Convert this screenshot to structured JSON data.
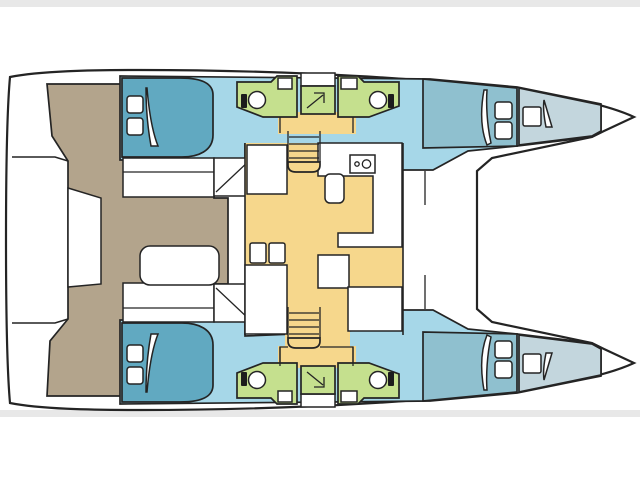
{
  "page": {
    "background": "#ffffff",
    "frame_color": "#e8e8e8"
  },
  "plan": {
    "vessel_type": "catamaran",
    "view": "top-down interior deck plan",
    "bow_direction": "right",
    "cabin_count": 4,
    "bathroom_count": 4,
    "staircase_count": 2,
    "companionway_arrow_count": 2
  },
  "colors": {
    "outline": "#242424",
    "deck": "#ffffff",
    "cabin_floor": "#a6d7e8",
    "bed": "#61a9c1",
    "forward_cabin": "#8fc0cf",
    "bow_locker": "#c3d6dd",
    "bathroom": "#c5e08e",
    "salon": "#f6d78c",
    "cockpit": "#b3a48c",
    "fixture_white": "#ffffff"
  },
  "rooms": {
    "port_aft_cabin": "double cabin aft (port)",
    "port_bathroom_aft": "bathroom (port aft)",
    "port_bathroom_fwd": "bathroom (port fwd)",
    "port_fwd_cabin": "double cabin fwd (port)",
    "port_bow_locker": "bow storage (port)",
    "stbd_aft_cabin": "double cabin aft (starboard)",
    "stbd_bathroom_aft": "bathroom (starboard aft)",
    "stbd_bathroom_fwd": "bathroom (starboard fwd)",
    "stbd_fwd_cabin": "double cabin fwd (starboard)",
    "stbd_bow_locker": "bow storage (starboard)",
    "salon": "salon / dinette",
    "galley": "galley",
    "cockpit": "aft cockpit",
    "swim_platform": "stern platforms",
    "trampoline": "foredeck / trampoline"
  },
  "fixtures": {
    "beds": "double berths with pillows",
    "toilets": "marine toilets",
    "sinks": "wash basins",
    "stove": "two-burner stove",
    "galley_sink": "galley sink",
    "stairs": "companionway staircases",
    "table": "cockpit table",
    "hatch": "bow deck hatch"
  }
}
